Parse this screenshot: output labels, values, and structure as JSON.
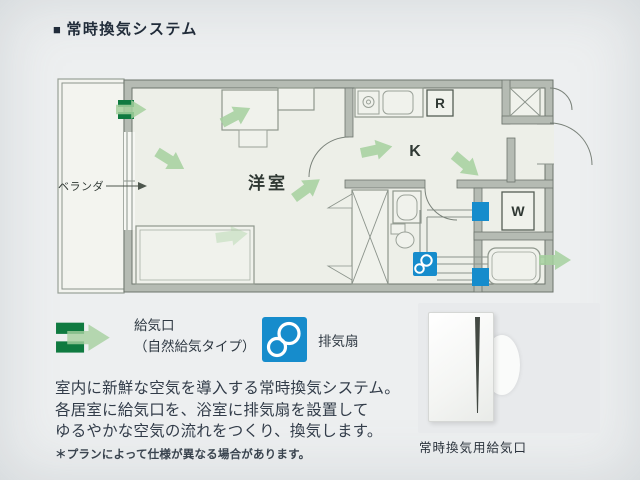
{
  "header": {
    "marker": "■",
    "title": "常時換気システム"
  },
  "plan": {
    "labels": {
      "balcony": "ベランダ",
      "western_room": "洋室",
      "kitchen": "K",
      "refrigerator": "R",
      "washing_machine": "W"
    }
  },
  "legend": {
    "supply_label_1": "給気口",
    "supply_label_2": "（自然給気タイプ）",
    "exhaust_label": "排気扇"
  },
  "description": {
    "lines": [
      "室内に新鮮な空気を導入する常時換気システム。",
      "各居室に給気口を、浴室に排気扇を設置して",
      "ゆるやかな空気の流れをつくり、換気します。"
    ],
    "note": "＊プランによって仕様が異なる場合があります。"
  },
  "photo": {
    "caption": "常時換気用給気口"
  },
  "colors": {
    "flow_green": "#a6d19f",
    "supply_green": "#0f7a40",
    "exhaust_blue": "#168ccc",
    "wall_fill": "#b5bbb3",
    "floor": "#edefe8",
    "text_dark": "#2b3540"
  }
}
